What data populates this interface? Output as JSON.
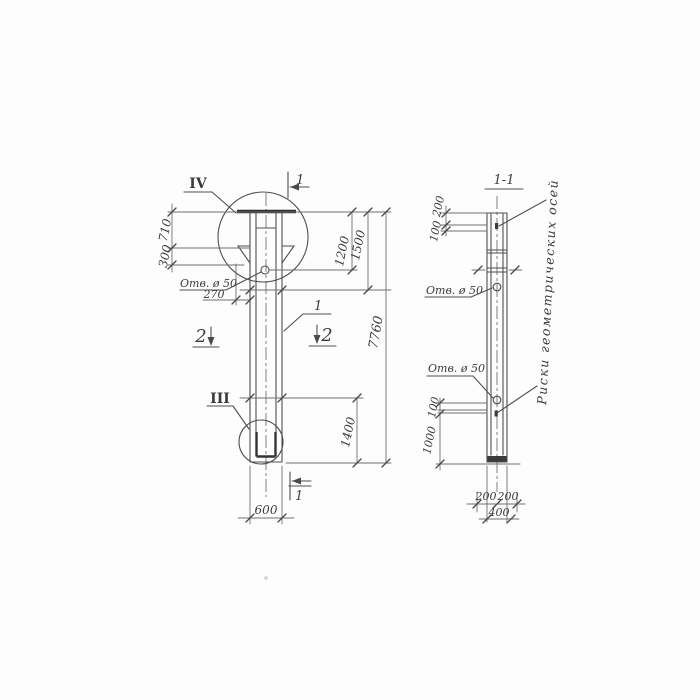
{
  "left_view": {
    "detail_marker_top": "IV",
    "detail_marker_bottom": "III",
    "section_mark_top": "1",
    "section_mark_bottom": "1",
    "section_mark_left": "2",
    "section_mark_right": "2",
    "part_callout": "1",
    "hole_label": "Отв. ø 50",
    "dim_710": "710",
    "dim_300": "300",
    "dim_270": "270",
    "dim_1200": "1200",
    "dim_1500": "1500",
    "dim_7760": "7760",
    "dim_1400": "1400",
    "dim_600": "600"
  },
  "section_view": {
    "title": "1-1",
    "dim_200_top": "200",
    "dim_100_top": "100",
    "hole_label_upper": "Отв. ø 50",
    "hole_label_lower": "Отв. ø 50",
    "dim_100_mid": "100",
    "dim_1000": "1000",
    "dim_200_bottom_left": "200",
    "dim_200_bottom_right": "200",
    "dim_400_bottom": "400",
    "axes_note": "Риски геометрических осей"
  },
  "colors": {
    "ink": "#4f4f4f",
    "dim_ink": "#707070",
    "paper": "#fdfdfd"
  }
}
